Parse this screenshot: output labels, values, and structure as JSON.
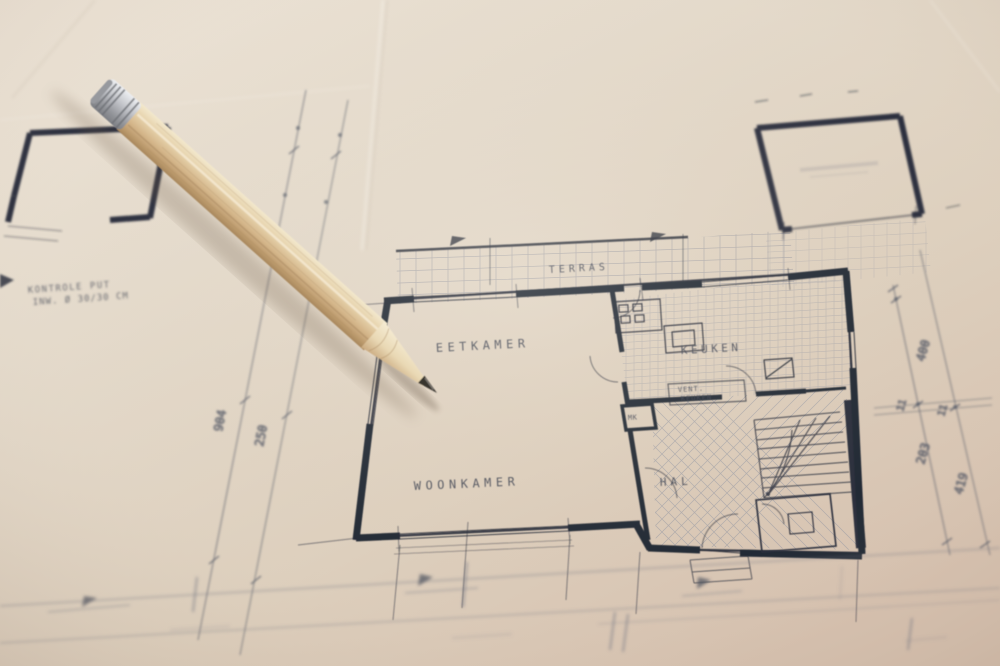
{
  "blueprint": {
    "room_labels": {
      "terras": "TERRAS",
      "eetkamer": "EETKAMER",
      "keuken": "KEUKEN",
      "vent_line1": "VENT.",
      "vent_line2": "KEUKEN",
      "meterkast": "MK",
      "woonkamer": "WOONKAMER",
      "hal": "HAL"
    },
    "handwritten_note": {
      "line1": "KONTROLE PUT",
      "line2": "INW. Ø 30/30 CM"
    },
    "dimensions_left": [
      "904",
      "250"
    ],
    "dimensions_right": [
      "400",
      "11",
      "11",
      "203",
      "419"
    ],
    "colors": {
      "paper": "#e4dacb",
      "paper_warm": "#d9c6b4",
      "ink_dark": "#242936",
      "ink_faint": "#8d93a2",
      "pencil_wood": "#d9c29c",
      "pencil_ferrule": "#b7b9bd",
      "pencil_graphite": "#37342f"
    }
  }
}
